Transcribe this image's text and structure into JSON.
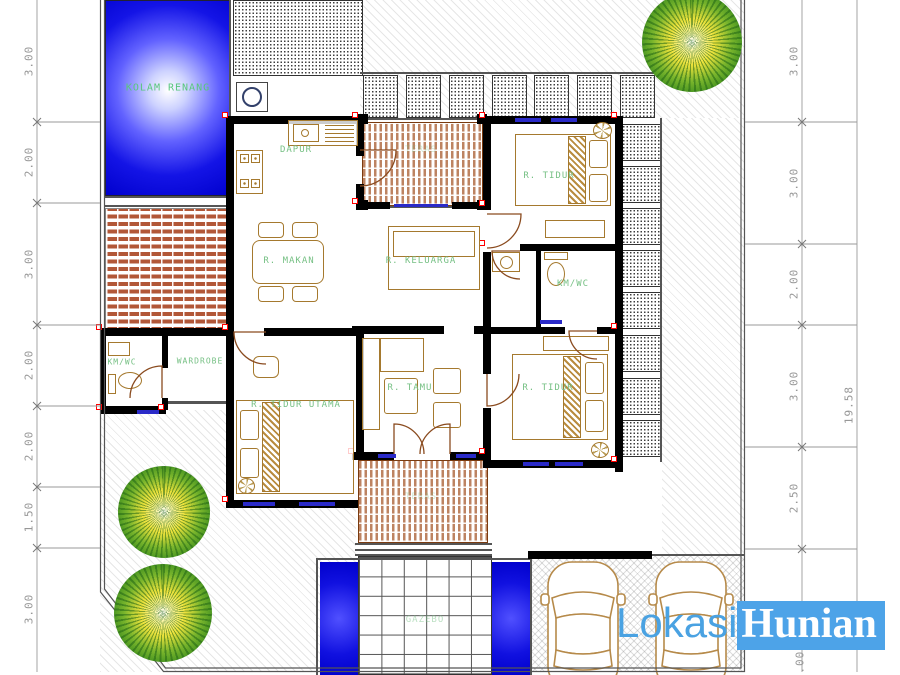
{
  "rooms": {
    "kolam_renang": "KOLAM RENANG",
    "dapur": "DAPUR",
    "r_makan": "R. MAKAN",
    "r_keluarga": "R. KELUARGA",
    "teras_atas": "TERAS",
    "r_tidur_1": "R. TIDUR",
    "km_wc_kanan": "KM/WC",
    "r_tidur_2": "R. TIDUR",
    "r_tamu": "R. TAMU",
    "km_wc_kiri": "KM/WC",
    "wardrobe": "WARDROBE",
    "r_tidur_utama": "R. TIDUR UTAMA",
    "teras_bawah": "TERAS",
    "gazebo": "GAZEBO"
  },
  "dims": {
    "left": [
      "3.00",
      "2.00",
      "3.00",
      "2.00",
      "2.00",
      "1.50",
      "3.00"
    ],
    "right": [
      "3.00",
      "3.00",
      "2.00",
      "3.00",
      "2.50",
      "3.00"
    ],
    "total_right": "19.58"
  },
  "watermark": {
    "part1": "Lokasi",
    "part2": "Hunian"
  },
  "colors": {
    "label_green": "#76c084",
    "watermark_text_blue": "#4aa2e2",
    "watermark_bg_blue": "#4da3e8",
    "pool_blue": "#0000cd",
    "wall_black": "#000000",
    "furniture_tan": "#a5792e",
    "accent_red": "#ff0000",
    "window_blue": "#2a2ac8"
  }
}
